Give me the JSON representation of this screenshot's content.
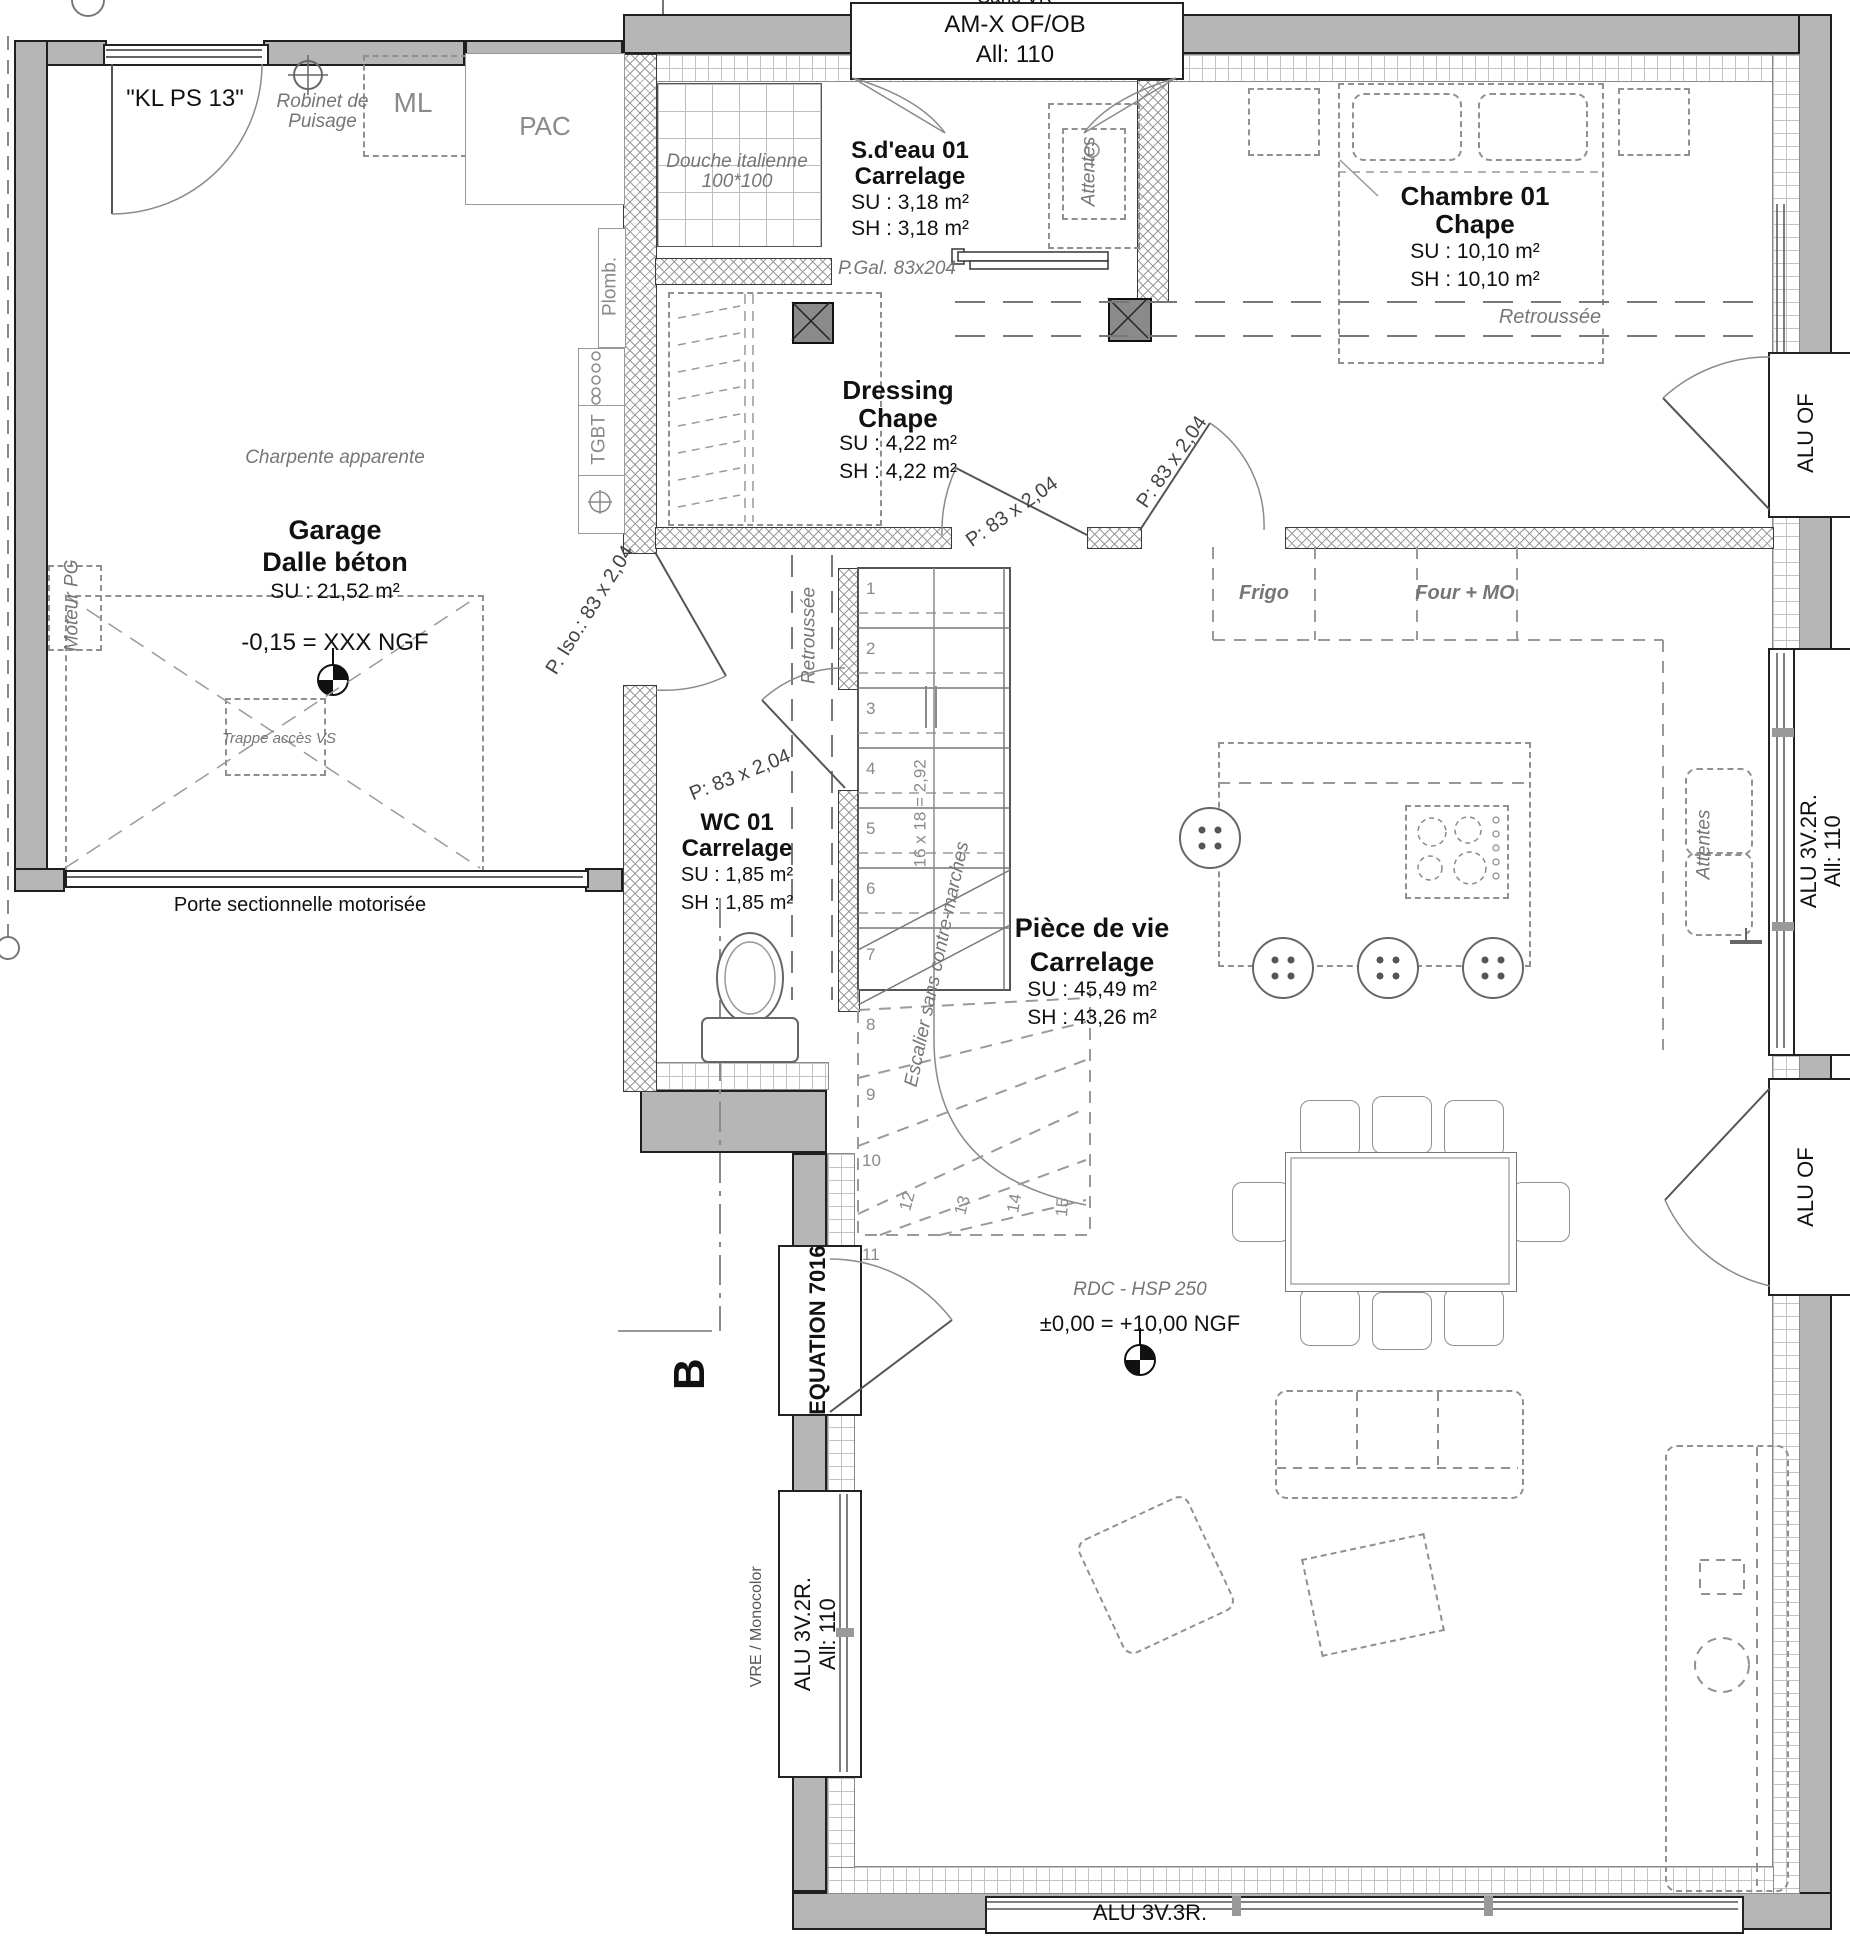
{
  "rooms": {
    "sdeau": {
      "name": "S.d'eau 01",
      "finish": "Carrelage",
      "su": "SU : 3,18 m²",
      "sh": "SH : 3,18 m²"
    },
    "chambre": {
      "name": "Chambre 01",
      "finish": "Chape",
      "su": "SU : 10,10 m²",
      "sh": "SH : 10,10 m²"
    },
    "dressing": {
      "name": "Dressing",
      "finish": "Chape",
      "su": "SU : 4,22 m²",
      "sh": "SH : 4,22 m²"
    },
    "wc": {
      "name": "WC 01",
      "finish": "Carrelage",
      "su": "SU : 1,85 m²",
      "sh": "SH : 1,85 m²"
    },
    "garage": {
      "name": "Garage",
      "finish": "Dalle béton",
      "su": "SU : 21,52 m²"
    },
    "vie": {
      "name": "Pièce de vie",
      "finish": "Carrelage",
      "su": "SU : 45,49 m²",
      "sh": "SH : 43,26 m²"
    }
  },
  "windows": {
    "top_note": "Sans VR",
    "top1": "AM-X OF/OB",
    "top2": "All:  110",
    "right_of_upper": "ALU OF",
    "right_3v2r_1": "ALU 3V.2R.",
    "right_3v2r_2": "All:  110",
    "right_of_lower": "ALU OF",
    "left_3v2r_1": "ALU 3V.2R.",
    "left_3v2r_2": "All:  110",
    "left_note": "VRE / Monocolor",
    "bottom": "ALU 3V.3R."
  },
  "doors": {
    "garage_entry": "\"KL PS 13\"",
    "pgal": "P.Gal. 83x204",
    "piso": "P. Iso.: 83 x 2,04",
    "p83_hall": "P: 83 x 2,04",
    "p83_chambre": "P: 83 x 2,04",
    "p83_wc": "P: 83 x 2,04",
    "entry": "EQUATION 7016",
    "sectional": "Porte sectionnelle motorisée"
  },
  "equipment": {
    "robinet1": "Robinet de",
    "robinet2": "Puisage",
    "ml": "ML",
    "pac": "PAC",
    "plomb": "Plomb.",
    "tgbt": "TGBT",
    "moteur": "Moteur PG",
    "douche1": "Douche italienne",
    "douche2": "100*100",
    "attentes_sdb": "Attentes",
    "attentes_cuisine": "Attentes",
    "frigo": "Frigo",
    "four": "Four + MO",
    "trappe": "Trappe accès VS"
  },
  "notes": {
    "charpente": "Charpente apparente",
    "retroussee_ch": "Retroussée",
    "retroussee_hall": "Retroussée",
    "escalier": "Escalier sans contre-marches",
    "formule": "16 x 18 = 2,92",
    "rdc": "RDC - HSP 250",
    "niveau_garage": "-0,15 = XXX NGF",
    "niveau_rdc": "±0,00 = +10,00 NGF",
    "coupe": "B"
  },
  "stairs": {
    "numbers": [
      "1",
      "2",
      "3",
      "4",
      "5",
      "6",
      "7",
      "8",
      "9",
      "10",
      "11",
      "12",
      "13",
      "14",
      "15"
    ]
  }
}
